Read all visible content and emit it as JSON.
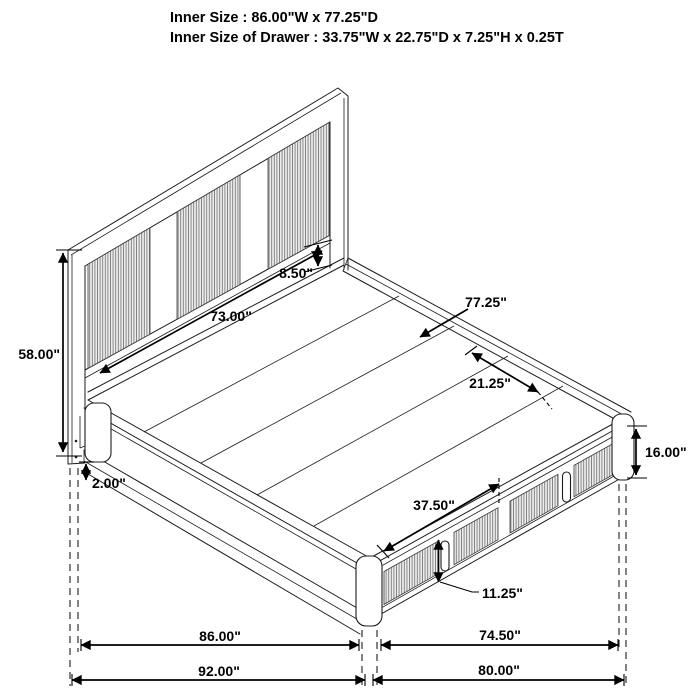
{
  "title": {
    "line1": "Inner Size : 86.00\"W x 77.25\"D",
    "line2": "Inner Size of Drawer : 33.75\"W x 22.75\"D x 7.25\"H x 0.25T"
  },
  "dimensions": {
    "headboard_height": "58.00\"",
    "base_clearance": "2.00\"",
    "headboard_panel_width": "73.00\"",
    "headboard_gap": "8.50\"",
    "platform_depth": "77.25\"",
    "deck_side_span": "21.25\"",
    "drawer_front_width": "37.50\"",
    "drawer_handle_height": "11.25\"",
    "frame_height": "16.00\"",
    "inner_width": "86.00\"",
    "footboard_inner_width": "74.50\"",
    "overall_width": "92.00\"",
    "overall_depth": "80.00\""
  },
  "colors": {
    "line": "#1c1c1c",
    "dimension": "#000000",
    "rib_fill": "#ededed",
    "rib_line": "#7b7b7b",
    "background": "#ffffff"
  }
}
